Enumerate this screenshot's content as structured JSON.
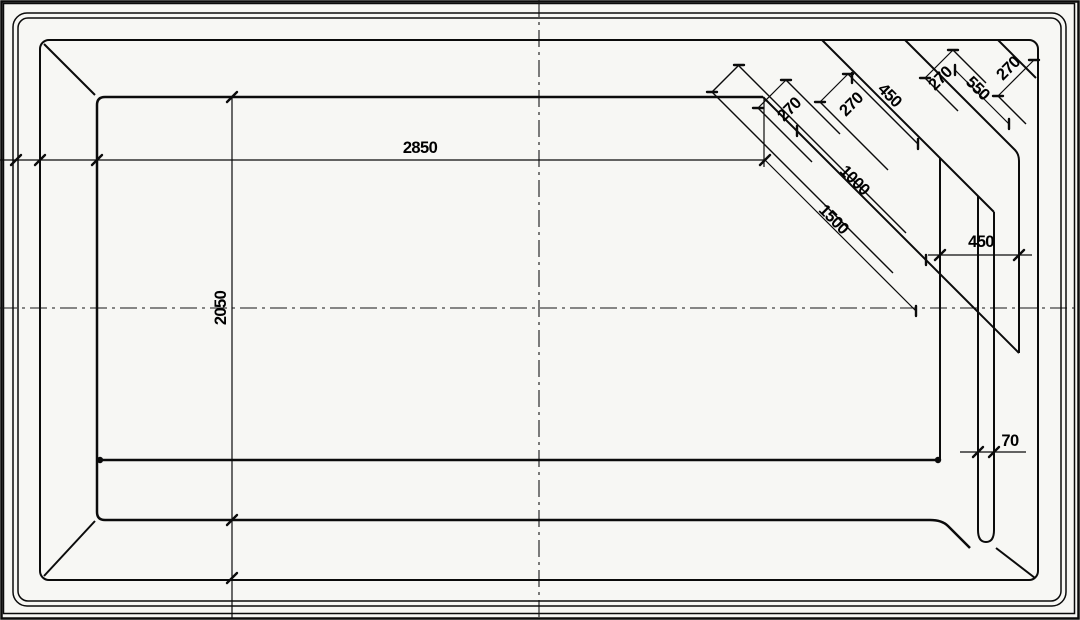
{
  "drawing": {
    "type": "pool-plan-top-view",
    "dims": {
      "inner_length": "2850",
      "inner_width": "2050",
      "step_edge_long": "1500",
      "step_edge_mid": "1000",
      "step_edge_upper": "550",
      "step_edge_top": "450",
      "tread_width_1": "270",
      "tread_width_2": "270",
      "tread_width_3": "270",
      "tread_width_4": "270",
      "bench_depth": "450",
      "channel_width": "70"
    },
    "line_color": "#0b0b0b",
    "background": "#f7f7f4"
  }
}
